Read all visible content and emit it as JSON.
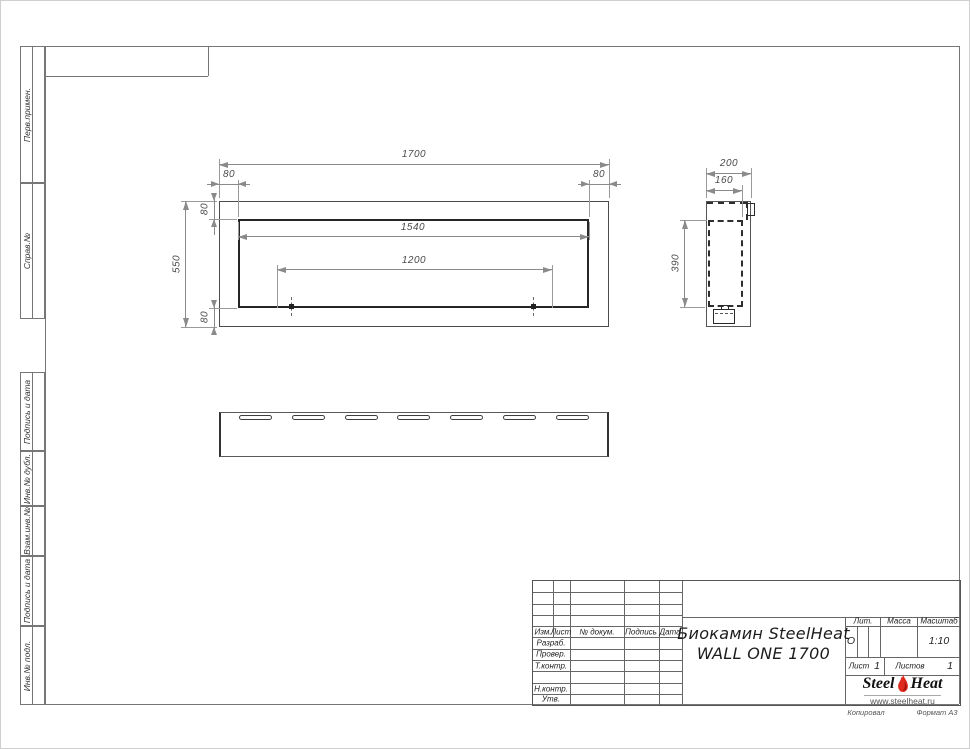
{
  "margin_labels": {
    "perv_primen": "Перв.примен.",
    "sprav_no": "Справ.№",
    "podpis_data_1": "Подпись и дата",
    "inv_no_dubl": "Инв.№ дубл.",
    "vzam_inv_no": "Взам.инв.№",
    "podpis_data_2": "Подпись и дата",
    "inv_no_podl": "Инв.№ подл."
  },
  "dimensions": {
    "front": {
      "total_width": "1700",
      "inset_left": "80",
      "inset_right": "80",
      "opening_width": "1540",
      "mount_span": "1200",
      "total_height": "550",
      "inset_top": "80",
      "inset_bottom": "80"
    },
    "side": {
      "depth": "200",
      "inner_depth": "160",
      "opening_height": "390"
    }
  },
  "bottom_view": {
    "slot_count": 7
  },
  "title_block": {
    "header_cols": {
      "izm": "Изм.",
      "list": "Лист",
      "dokum": "№ докум.",
      "podpis": "Подпись",
      "data": "Дата"
    },
    "sig_rows": {
      "razrab": "Разраб.",
      "prover": "Провер.",
      "t_kontr": "Т.контр.",
      "n_kontr": "Н.контр.",
      "utv": "Утв."
    },
    "doc_title_line1": "Биокамин SteelHeat",
    "doc_title_line2": "WALL ONE 1700",
    "lit_label": "Лит.",
    "lit_value": "О",
    "massa_label": "Масса",
    "masshtab_label": "Масштаб",
    "masshtab_value": "1:10",
    "list_label": "Лист",
    "list_value": "1",
    "listov_label": "Листов",
    "listov_value": "1",
    "logo": {
      "steel": "Steel",
      "heat": "Heat",
      "url": "www.steelheat.ru",
      "flame_color": "#de2a1c"
    },
    "footer": {
      "kopiroval": "Копировал",
      "format": "Формат А3"
    }
  }
}
